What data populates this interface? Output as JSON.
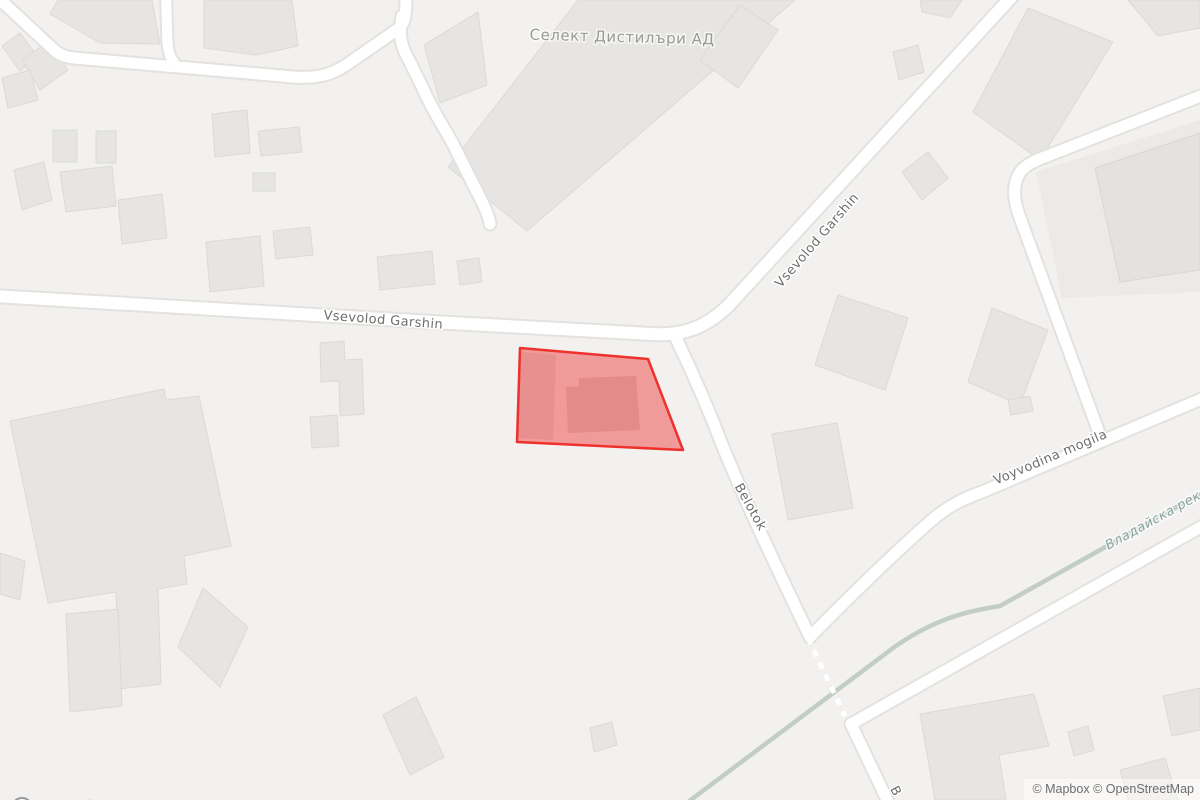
{
  "map": {
    "style": "mapbox-light",
    "colors": {
      "background": "#f2f1ef",
      "building_fill": "#e6e5e3",
      "building_stroke": "#dbdad7",
      "area_fill": "#eceae8",
      "road_fill": "#ffffff",
      "road_casing": "#e3e2df",
      "river": "#c3cdc7",
      "parcel_fill": "rgba(238,70,68,0.5)",
      "parcel_stroke": "#ef312e",
      "street_label": "#6e6e6c",
      "place_label": "#9b9996",
      "water_label": "#8ba39e",
      "attribution_text": "#6d6d6d",
      "logo_gray": "#979797"
    },
    "labels": {
      "place": {
        "text": "Селект Дистилъри АД"
      },
      "streets": [
        {
          "text": "Vsevolod Garshin"
        },
        {
          "text": "Vsevolod Garshin"
        },
        {
          "text": "Belotok"
        },
        {
          "text": "Voyvodina mogila"
        },
        {
          "text": "B"
        }
      ],
      "waterway": {
        "text": "Владайска рек"
      }
    },
    "highlight": {
      "feature": "selected-parcel"
    }
  },
  "branding": {
    "logo_text": "mapbox"
  },
  "attribution": {
    "text": "© Mapbox © OpenStreetMap"
  }
}
